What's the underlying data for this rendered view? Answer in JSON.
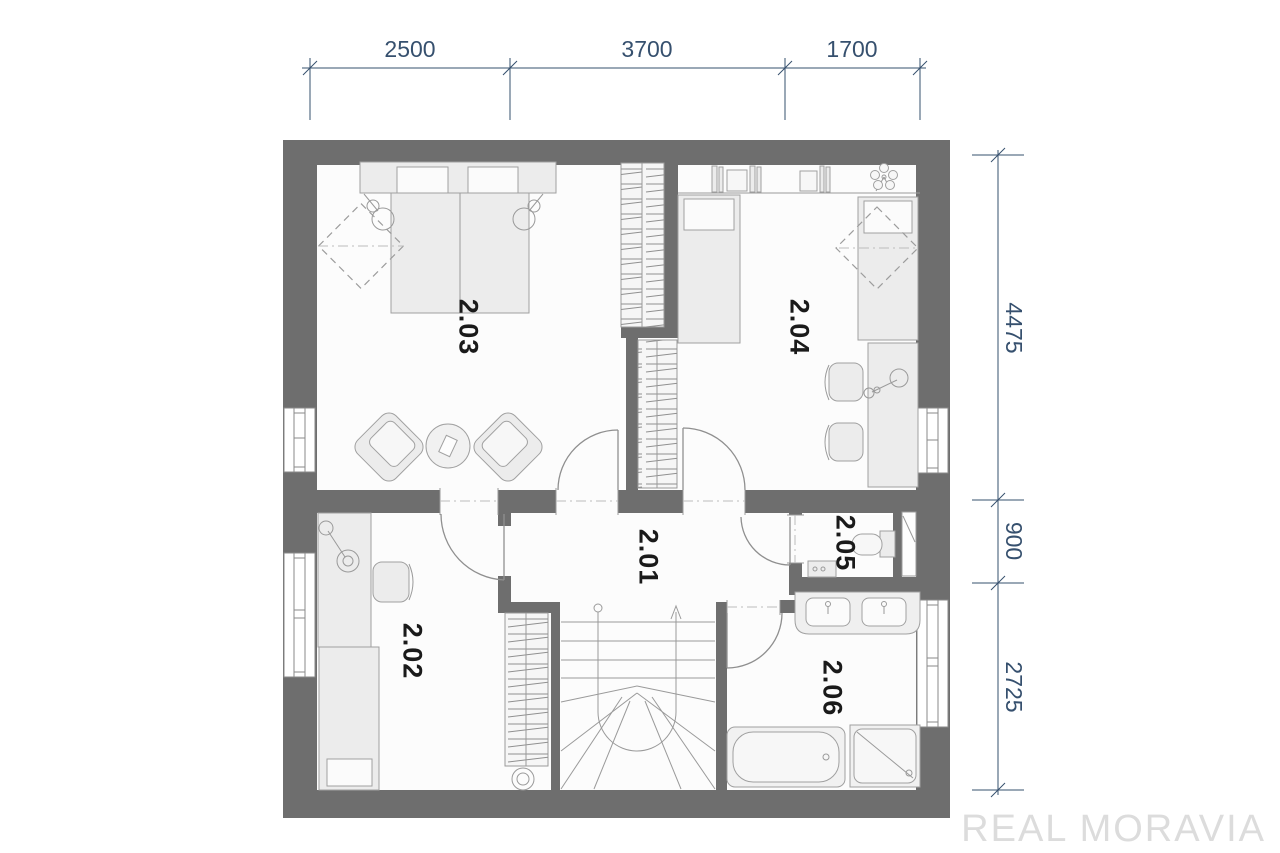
{
  "plan": {
    "type": "floor-plan",
    "watermark": "REAL MORAVIA",
    "colors": {
      "wall": "#6e6e6e",
      "floor": "#fcfcfc",
      "furniture_fill": "#ececec",
      "furniture_stroke": "#a0a0a0",
      "dimension": "#36506e",
      "room_label": "#1a1a1a",
      "watermark": "#dcdcdc"
    },
    "rooms": [
      {
        "label": "2.01",
        "kind": "hall"
      },
      {
        "label": "2.02",
        "kind": "room"
      },
      {
        "label": "2.03",
        "kind": "bedroom"
      },
      {
        "label": "2.04",
        "kind": "bedroom"
      },
      {
        "label": "2.05",
        "kind": "wc"
      },
      {
        "label": "2.06",
        "kind": "bathroom"
      }
    ],
    "dimensions_top": [
      {
        "value": "2500"
      },
      {
        "value": "3700"
      },
      {
        "value": "1700"
      }
    ],
    "dimensions_right": [
      {
        "value": "4475"
      },
      {
        "value": "900"
      },
      {
        "value": "2725"
      }
    ]
  }
}
